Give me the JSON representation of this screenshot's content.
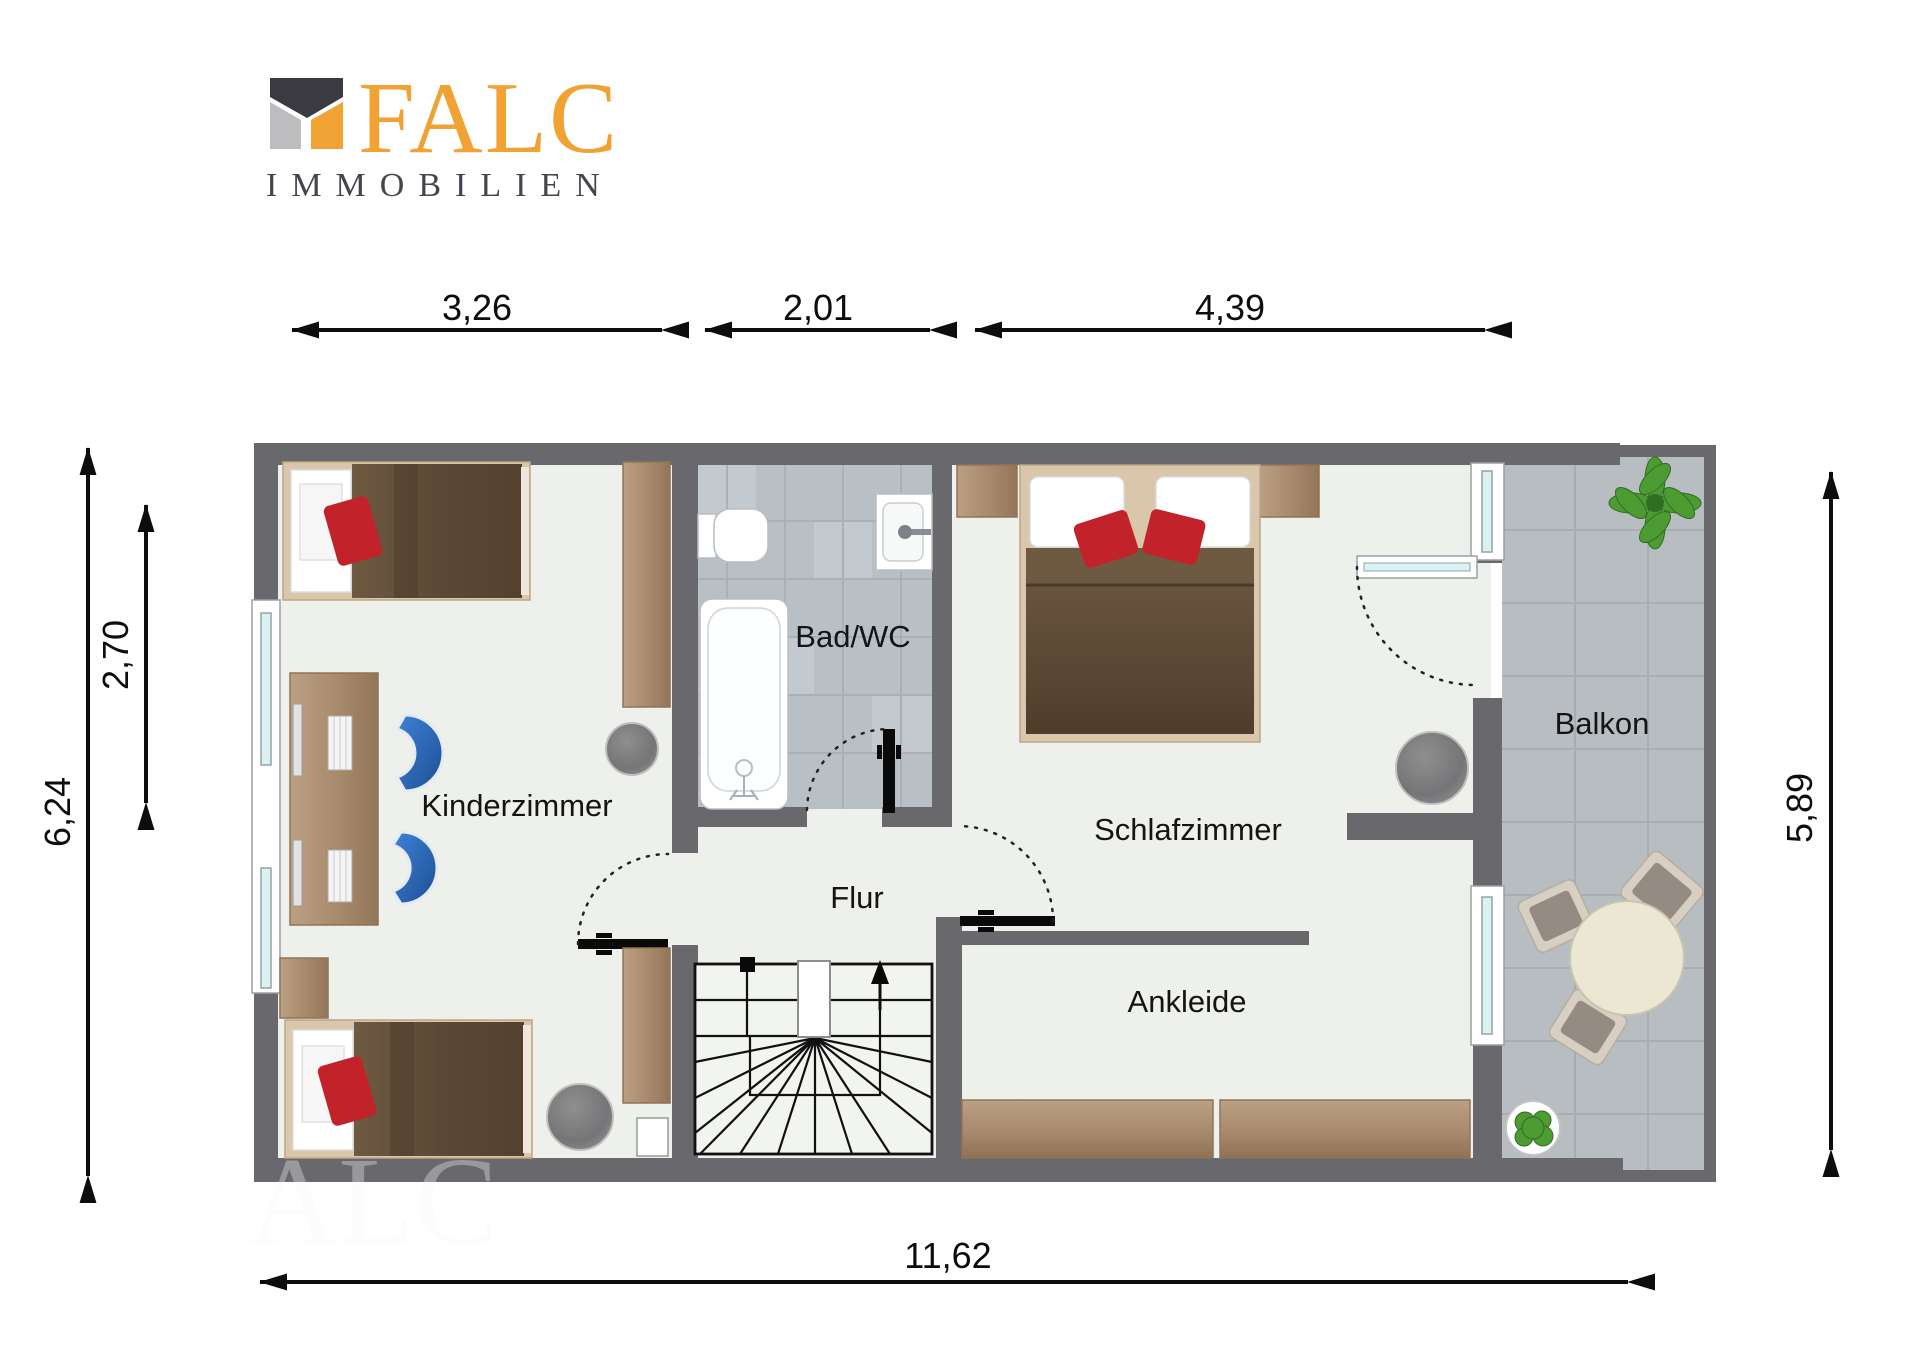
{
  "logo": {
    "brand": "FALC",
    "subtitle": "IMMOBILIEN",
    "accent_color": "#F0A232",
    "dark_color": "#3A3A40",
    "gray_color": "#BDBDBF",
    "subtitle_color": "#45454D"
  },
  "watermark": "ALC",
  "rooms": {
    "kinderzimmer": "Kinderzimmer",
    "bad": "Bad/WC",
    "schlafzimmer": "Schlafzimmer",
    "flur": "Flur",
    "ankleide": "Ankleide",
    "balkon": "Balkon"
  },
  "dimensions": {
    "top": [
      "3,26",
      "2,01",
      "4,39"
    ],
    "left_overall": "6,24",
    "left_partial": "2,70",
    "right": "5,89",
    "bottom": "11,62"
  },
  "colors": {
    "wall": "#68686D",
    "floor": "#EEF0EC",
    "bath_tile": "#B8C0C6",
    "balcony_tile": "#B7BDC0",
    "window_glass": "#D9F3F5",
    "wood": "#AB8D6F",
    "blanket_brown": "#5F4C38",
    "bed_frame": "#D9C6AB",
    "pillow_red": "#C2232A",
    "chair_blue": "#2F6FC0",
    "plant_green": "#4E9A33"
  }
}
